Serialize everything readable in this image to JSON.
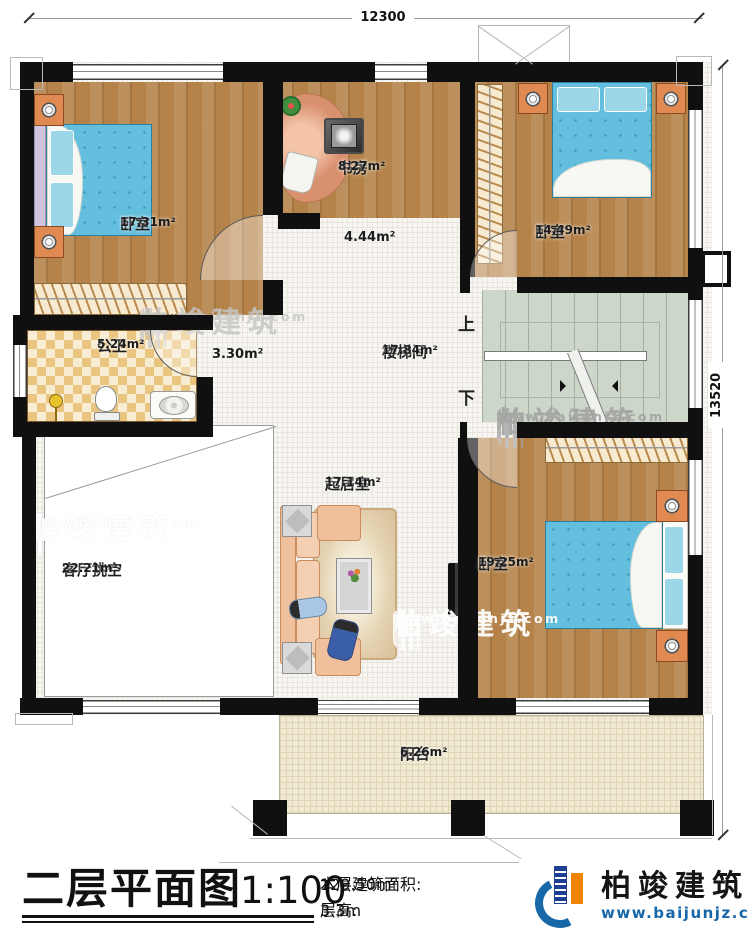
{
  "dims": {
    "width_label": "12300",
    "height_label": "13520"
  },
  "rooms": {
    "bedroom1": {
      "name": "卧室",
      "area": "17.31m²"
    },
    "study": {
      "name": "书房",
      "area": "8.27m²"
    },
    "bedroom2": {
      "name": "卧室",
      "area": "14.49m²"
    },
    "hallway": {
      "area": "4.44m²"
    },
    "bath": {
      "name": "公卫",
      "area": "5.24m²"
    },
    "corridor": {
      "area": "3.30m²"
    },
    "stair": {
      "name": "楼梯间",
      "area": "17.84m²",
      "up": "上",
      "down": "下"
    },
    "living": {
      "name": "起居室",
      "area": "17.14m²"
    },
    "void": {
      "name": "客厅挑空",
      "area": "22.21m²"
    },
    "bedroom3": {
      "name": "卧室",
      "area": "19.25m²"
    },
    "balcony": {
      "name": "阳台",
      "area": "6.26m²"
    }
  },
  "footer": {
    "title": "二层平面图",
    "scale": "1:100",
    "area_label": "本层建筑面积: ",
    "area_value": "129.50m²",
    "height_label": "层高: ",
    "height_value": "3.3m"
  },
  "brand": {
    "name": "柏竣建筑",
    "url": "www.baijunjz.com"
  },
  "watermark": {
    "name": "柏竣建筑",
    "url": "www.baijunjz.com"
  },
  "colors": {
    "wall": "#101010",
    "brand_blue": "#1767a9",
    "brand_orange": "#f08300",
    "wood": "#b5834a",
    "stair_green": "#ccd6c9"
  }
}
